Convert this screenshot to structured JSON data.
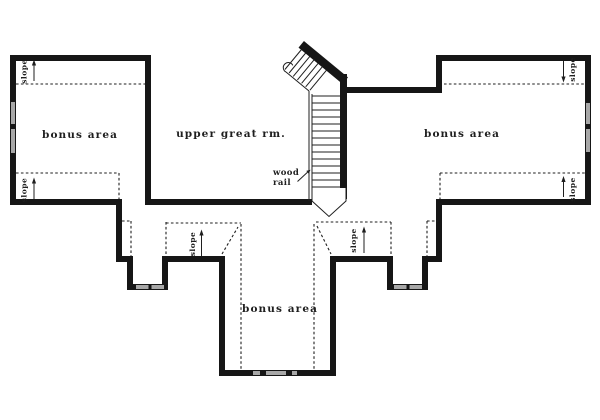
{
  "colors": {
    "wall": "#161616",
    "line": "#1f1f1f",
    "window": "#a8a8a8",
    "bg": "#ffffff"
  },
  "rooms": {
    "bonus_left": "bonus area",
    "upper_great": "upper great rm.",
    "bonus_right": "bonus area",
    "bonus_bottom": "bonus area"
  },
  "annotations": {
    "slope": "slope",
    "wood_rail": {
      "line1": "wood",
      "line2": "rail"
    }
  }
}
